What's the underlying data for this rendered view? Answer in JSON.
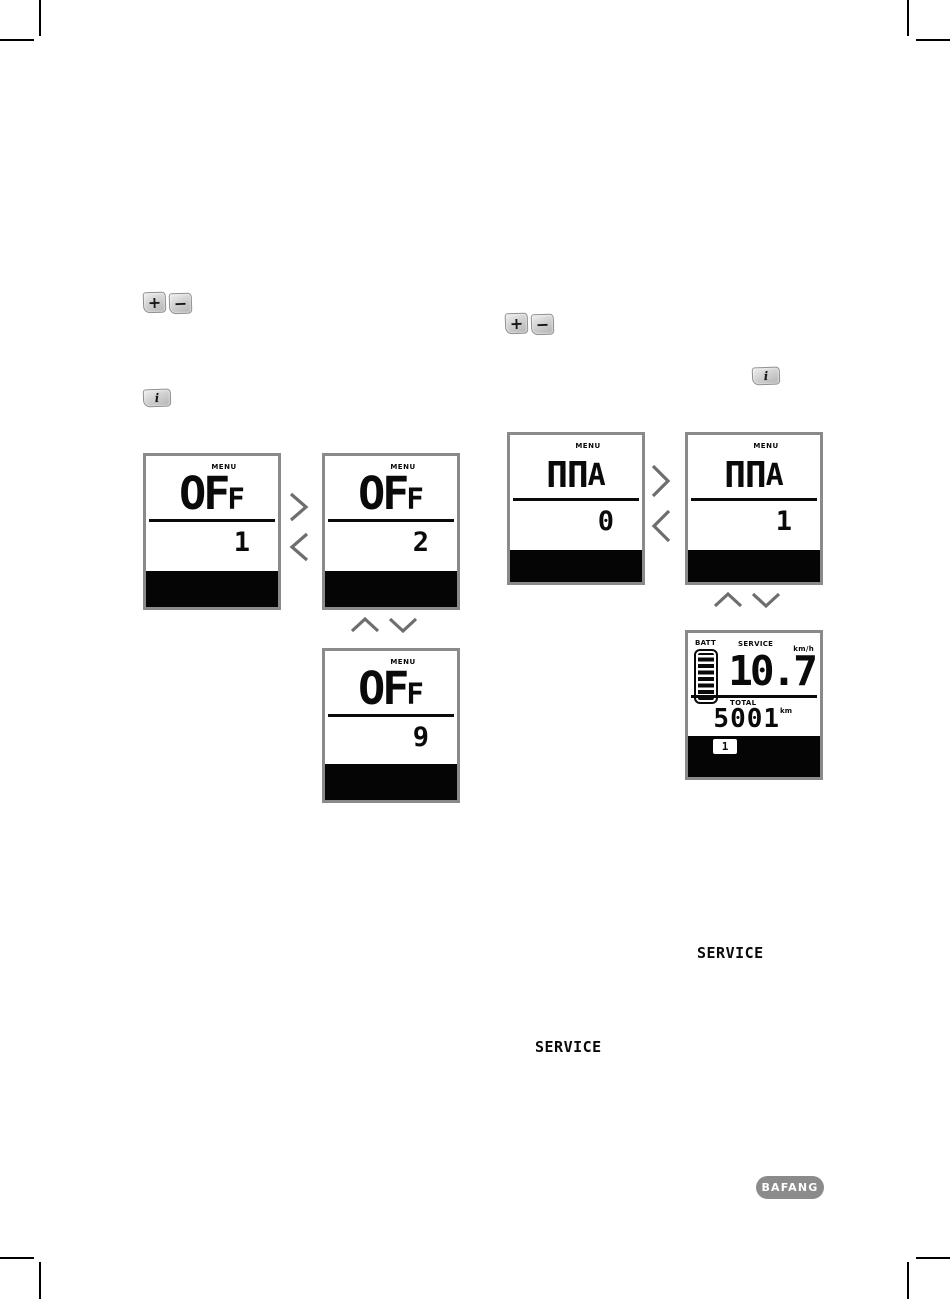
{
  "keys": {
    "plus": "+",
    "minus": "−",
    "info": "i"
  },
  "panels": [
    {
      "menu": "MENU",
      "main": "OF",
      "suffix": "F",
      "sub": "1"
    },
    {
      "menu": "MENU",
      "main": "OF",
      "suffix": "F",
      "sub": "2"
    },
    {
      "menu": "MENU",
      "main": "OF",
      "suffix": "F",
      "sub": "9"
    },
    {
      "menu": "MENU",
      "main": "ΠΠ",
      "suffix": "A",
      "sub": "0"
    },
    {
      "menu": "MENU",
      "main": "ΠΠ",
      "suffix": "A",
      "sub": "1"
    }
  ],
  "dashboard": {
    "batt_label": "BATT",
    "service_label": "SERVICE",
    "speed": "10.7",
    "speed_unit": "km/h",
    "total_label": "TOTAL",
    "total_value": "5001",
    "total_unit": "km",
    "assist_level": "1"
  },
  "service_text_right": "SERVICE",
  "service_text_left": "SERVICE",
  "logo_text": "BAFANG",
  "colors": {
    "panel_border": "#8a8a8a",
    "lcd_black": "#050505",
    "chevron_gray": "#6e6e6e",
    "logo_gray": "#8b8b8b"
  }
}
